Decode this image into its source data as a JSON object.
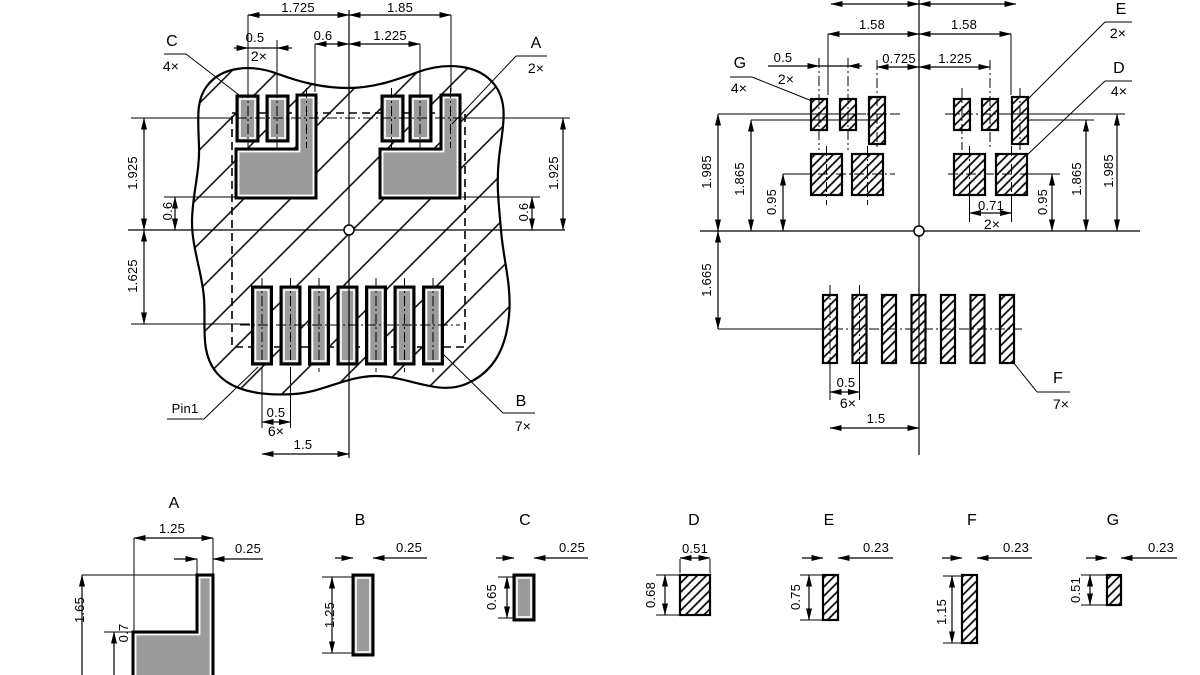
{
  "page": {
    "background": "#ffffff",
    "line_color": "#000000",
    "pad_fill": "#9b9b9b"
  },
  "view1": {
    "name": "copper-land-pattern",
    "dims": {
      "top_left_span": "1.725",
      "top_right_span": "1.85",
      "pad_pitch": "0.5",
      "pad_pitch_count": "2×",
      "center_offset": "0.6",
      "inner_span": "1.225",
      "left_upper": "1.925",
      "left_step": "0.6",
      "left_lower": "1.625",
      "right_upper": "1.925",
      "right_step": "0.6",
      "bottom_pitch": "0.5",
      "bottom_pitch_count": "6×",
      "bottom_span": "1.5"
    },
    "callouts": {
      "c": "C",
      "c_count": "4×",
      "a": "A",
      "a_count": "2×",
      "b": "B",
      "b_count": "7×",
      "pin1": "Pin1"
    }
  },
  "view2": {
    "name": "solder-paste-stencil-pattern",
    "dims": {
      "top_cut_left": "1.725",
      "top_cut_right": "1.725",
      "top_left_span": "1.58",
      "top_right_span": "1.58",
      "pad_pitch": "0.5",
      "pad_pitch_count": "2×",
      "center_offset": "0.725",
      "inner_span": "1.225",
      "left_outer": "1.985",
      "left_inner": "1.865",
      "left_step": "0.95",
      "left_lower": "1.665",
      "right_pair": "0.71",
      "right_pair_count": "2×",
      "right_step": "0.95",
      "right_inner": "1.865",
      "right_outer": "1.985",
      "bottom_pitch": "0.5",
      "bottom_pitch_count": "6×",
      "bottom_span": "1.5"
    },
    "callouts": {
      "g": "G",
      "g_count": "4×",
      "e": "E",
      "e_count": "2×",
      "d": "D",
      "d_count": "4×",
      "f": "F",
      "f_count": "7×"
    }
  },
  "details": {
    "a": {
      "label": "A",
      "width": "1.25",
      "stub_width": "0.25",
      "height": "1.65",
      "lower_height": "0.7"
    },
    "b": {
      "label": "B",
      "width": "0.25",
      "height": "1.25"
    },
    "c": {
      "label": "C",
      "width": "0.25",
      "height": "0.65"
    },
    "d": {
      "label": "D",
      "width": "0.51",
      "height": "0.68"
    },
    "e": {
      "label": "E",
      "width": "0.23",
      "height": "0.75"
    },
    "f": {
      "label": "F",
      "width": "0.23",
      "height": "1.15"
    },
    "g": {
      "label": "G",
      "width": "0.23",
      "height": "0.51"
    }
  }
}
